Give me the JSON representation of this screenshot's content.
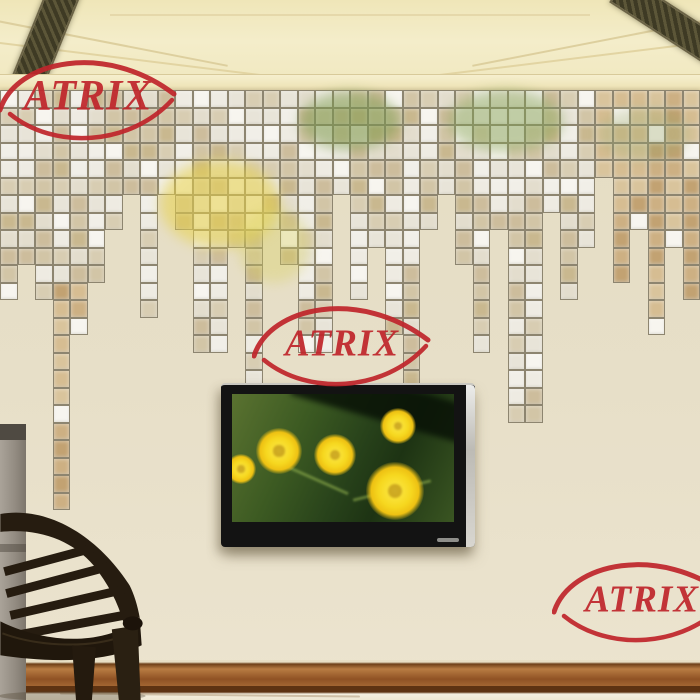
{
  "image_type": "product-photo",
  "brand": {
    "name": "ATRIX",
    "color": "#c0262c"
  },
  "watermarks": {
    "count": 3,
    "positions": [
      "top-left",
      "center",
      "bottom-right"
    ]
  },
  "scene": {
    "subject": "mirror mosaic tile wall sticker cascade on beige living-room wall",
    "wall_color": "#e6dec6",
    "ceiling_color": "#f1e9c2",
    "baseboard_color": "#8f5224",
    "floor_color": "#f5efdf",
    "objects": [
      "coffered ceiling with dark lattice vents",
      "mosaic mirror sticker cascade",
      "wall-mounted flat tv",
      "dark fan-back chair",
      "gray pillar"
    ]
  },
  "mosaic": {
    "columns": 40,
    "tile_size": 17.5,
    "grout_color": "#8d8570",
    "white": "#f7f5ef",
    "palette": [
      "#eeebe2",
      "#e3ddcd",
      "#d8cdb2",
      "#cdbd9c",
      "#e8e4d8",
      "#d2c5a6",
      "#f1efe8",
      "#c9b88f"
    ],
    "tan_palette": [
      "#cdb083",
      "#d6bd92",
      "#c2a272",
      "#d9c49c"
    ],
    "column_depths": [
      12,
      10,
      12,
      24,
      14,
      11,
      8,
      6,
      13,
      6,
      8,
      15,
      15,
      9,
      17,
      8,
      10,
      15,
      15,
      6,
      12,
      9,
      14,
      17,
      8,
      6,
      10,
      15,
      8,
      19,
      19,
      7,
      12,
      9,
      5,
      11,
      8,
      14,
      9,
      12
    ],
    "reflections": [
      {
        "x": 300,
        "y": 2,
        "w": 100,
        "h": 58,
        "color": "#7a9a4a",
        "opacity": 0.5
      },
      {
        "x": 448,
        "y": 0,
        "w": 115,
        "h": 62,
        "color": "#86a455",
        "opacity": 0.45
      },
      {
        "x": 160,
        "y": 70,
        "w": 120,
        "h": 88,
        "color": "#e8d24a",
        "opacity": 0.55
      },
      {
        "x": 238,
        "y": 118,
        "w": 72,
        "h": 75,
        "color": "#d8d05a",
        "opacity": 0.35
      },
      {
        "x": 598,
        "y": 18,
        "w": 92,
        "h": 52,
        "color": "#9aa86a",
        "opacity": 0.3
      }
    ]
  },
  "tv": {
    "bezel_color": "#131313",
    "side_trim_color": "#d8d6d0",
    "screen_subject": "yellow daisy flowers on green foliage",
    "flowers": [
      {
        "x": 24,
        "y": 34,
        "size": 46
      },
      {
        "x": 82,
        "y": 40,
        "size": 42
      },
      {
        "x": 148,
        "y": 14,
        "size": 36
      },
      {
        "x": 134,
        "y": 68,
        "size": 58
      },
      {
        "x": -6,
        "y": 60,
        "size": 30
      }
    ]
  }
}
